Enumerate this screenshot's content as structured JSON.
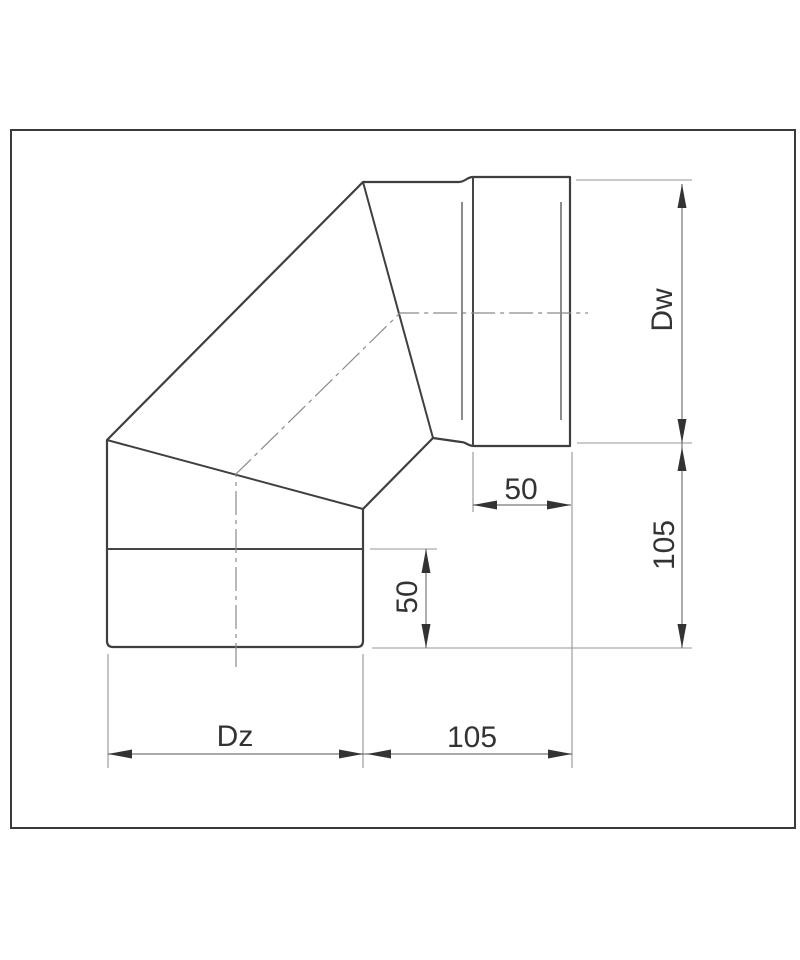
{
  "diagram": {
    "labels": {
      "inner_diameter": "Dw",
      "outer_diameter": "Dz",
      "right_side_length": "105",
      "bottom_length": "105",
      "right_socket_depth": "50",
      "bottom_socket_depth": "50"
    }
  },
  "colors": {
    "frame": "#3a3a3a",
    "contour": "#3f3f3f",
    "seam": "#4d4d4d",
    "dimension_line": "#777777",
    "extension_line": "#949494",
    "arrow": "#333333",
    "text": "#333333",
    "background": "#ffffff"
  }
}
